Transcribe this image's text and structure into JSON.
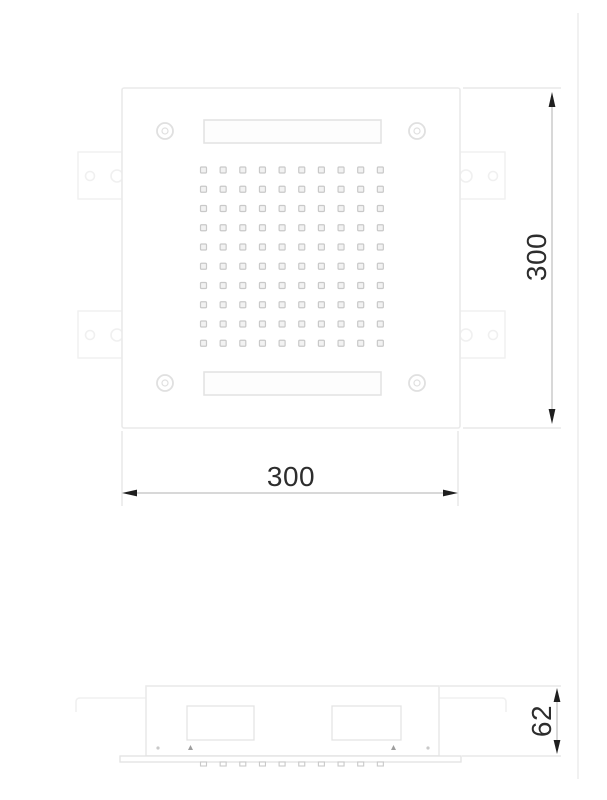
{
  "drawing": {
    "type": "technical-drawing",
    "subject": "square ceiling shower head, top view and side view"
  },
  "views": {
    "top": {
      "label": "top-view",
      "width_dim": {
        "value": "300"
      },
      "height_dim": {
        "value": "300"
      },
      "nozzle_grid": {
        "rows": 10,
        "cols": 10
      }
    },
    "side": {
      "label": "side-view",
      "depth_dim": {
        "value": "62"
      },
      "nozzle_ticks": 10
    }
  },
  "colors": {
    "background": "#ffffff",
    "plate-line": "#eaeaea",
    "tab-line": "#f0f0f0",
    "slot-line": "#e2e2e2",
    "ring-line": "#e0e0e0",
    "nozzle-line": "#c9c9c9",
    "pin": "#9e9e9e",
    "ext-line": "#e3e3e3",
    "dim-line": "#b0b0b0",
    "arrow": "#1f1f1f",
    "text": "#2d2d2d",
    "page-edge": "#f1f1f1"
  }
}
